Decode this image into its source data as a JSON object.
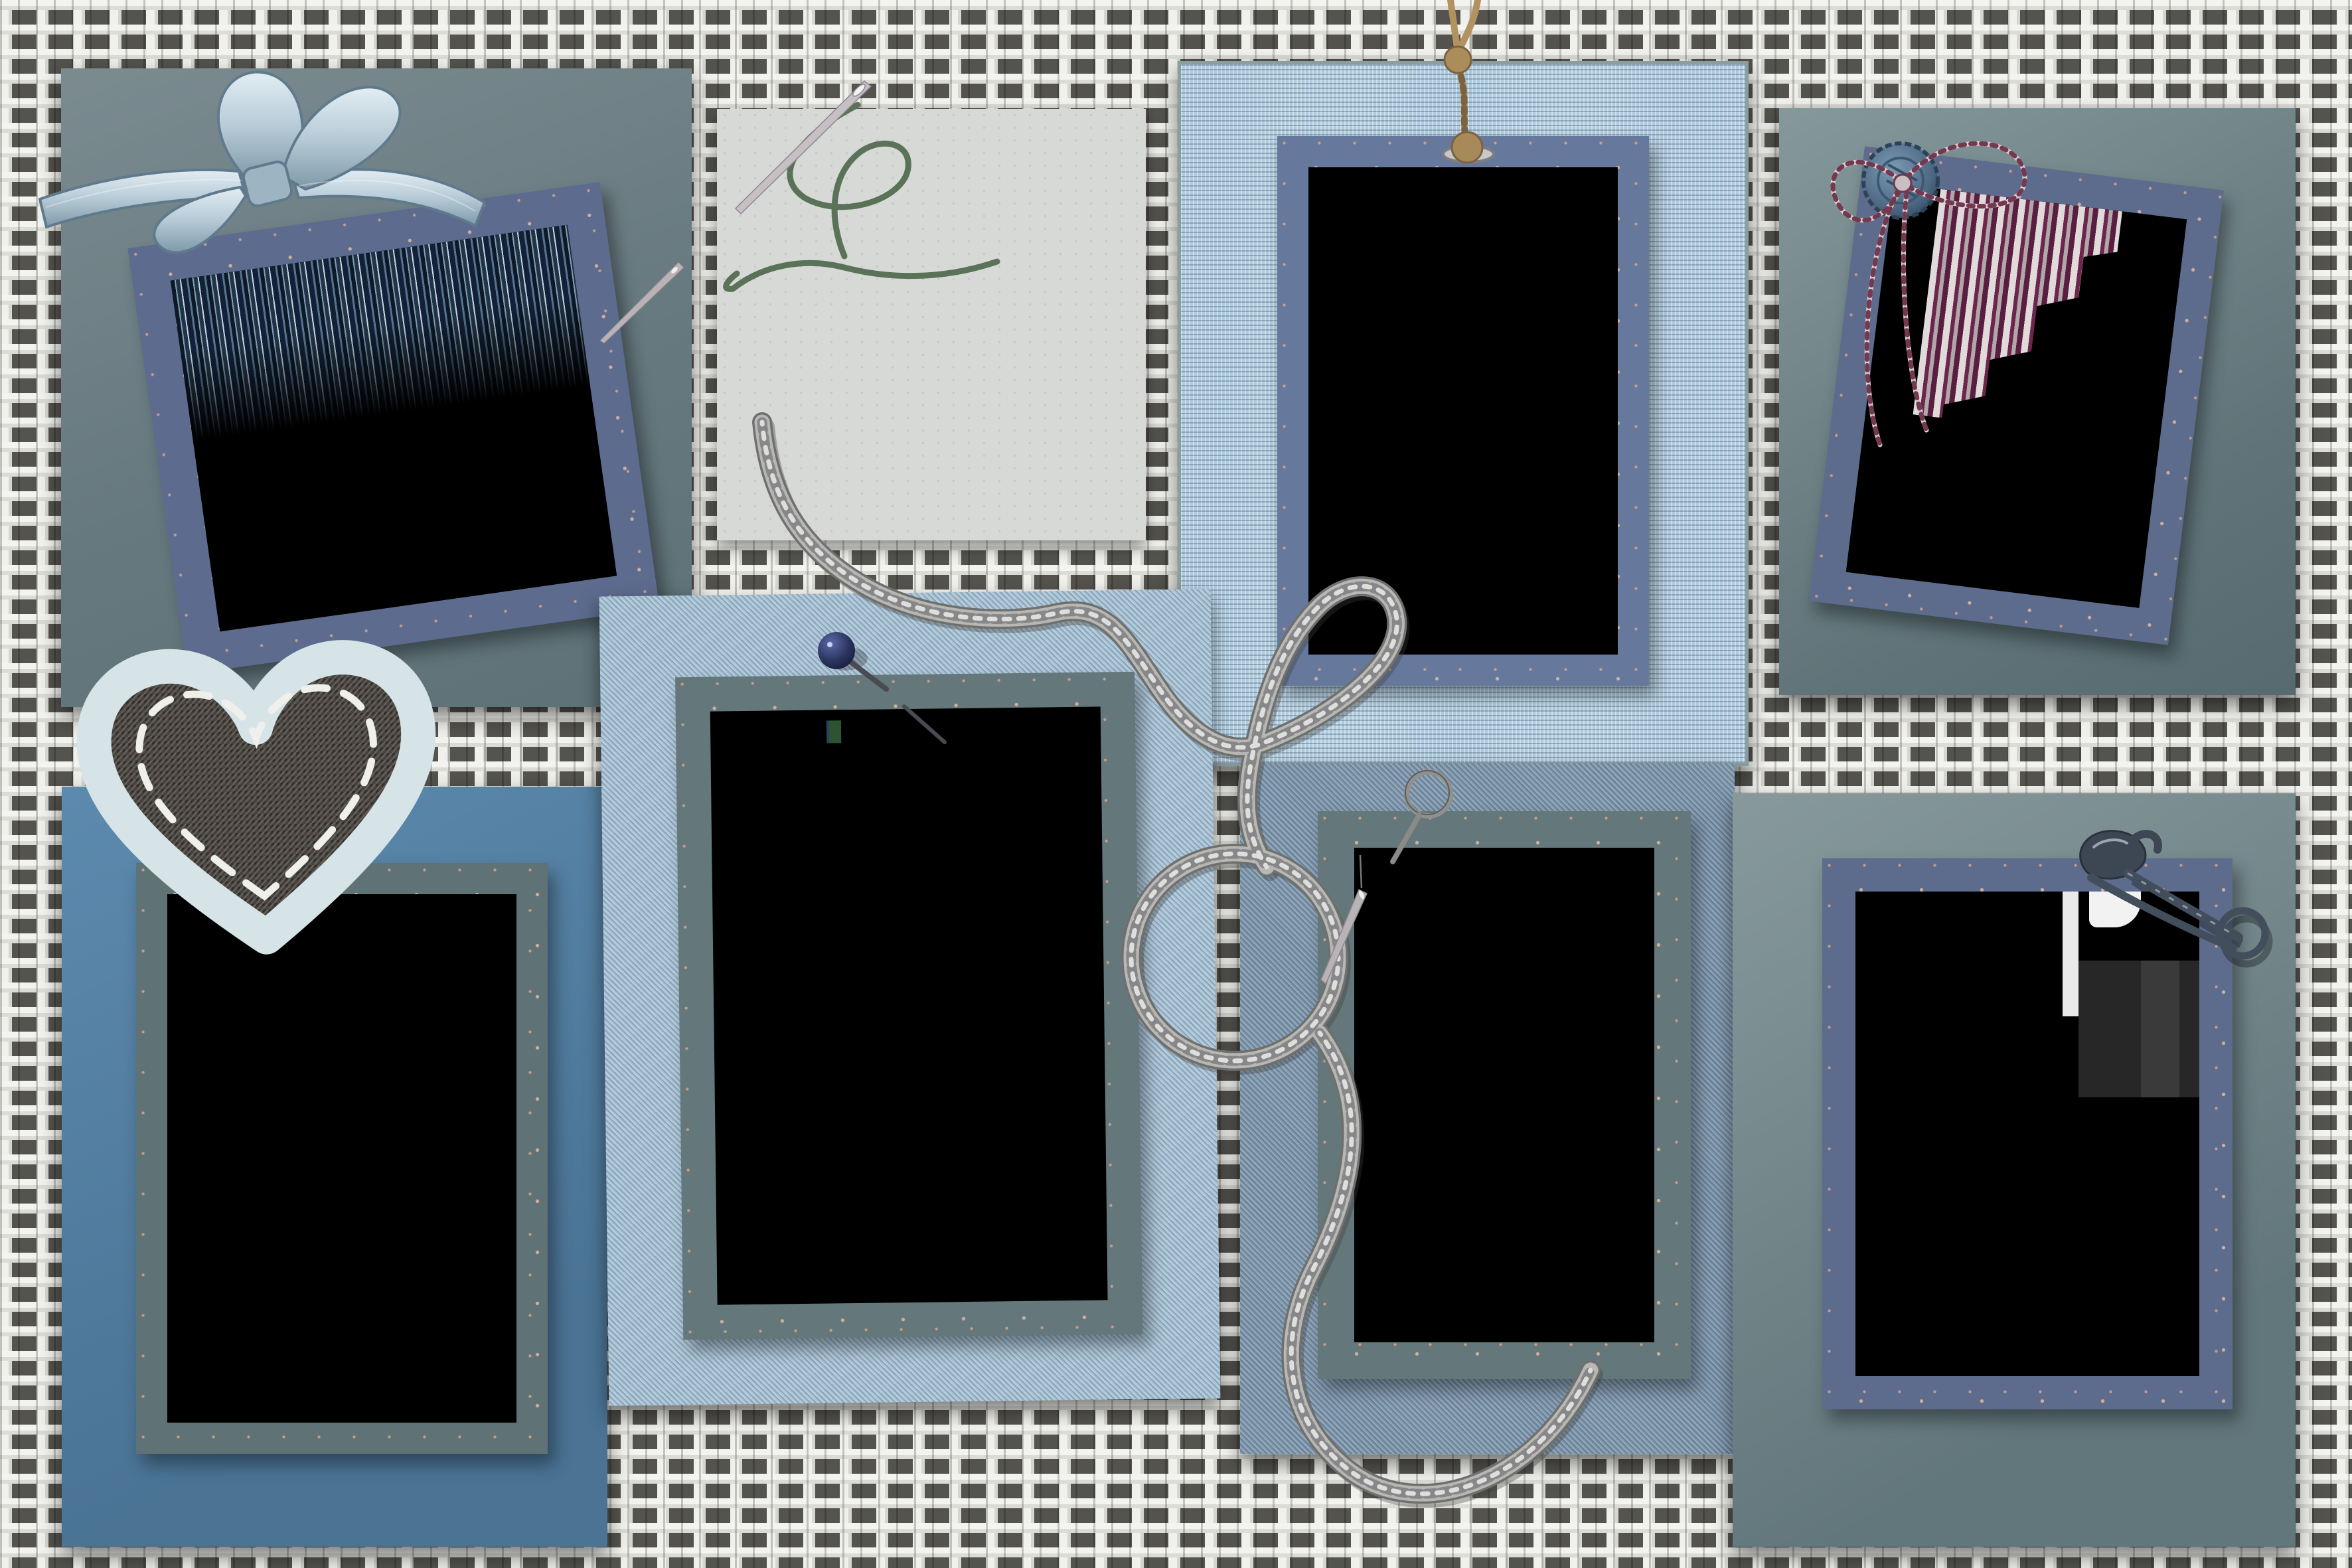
{
  "scene": {
    "label": "digital scrapbook photo-collage template on white burlap",
    "background": {
      "name": "burlap-weave-background",
      "label": "white burlap woven fabric",
      "thread_color": "#f2f2ef",
      "gap_color": "#4e4d4a"
    },
    "colors": {
      "slate_frame": "#5d6c8e",
      "sage_frame": "#64777b",
      "sage_mat": "#6e8288",
      "grey_mat": "#7b8e90",
      "light_blue_twill_mat": "#a9c3d6",
      "linen_mat": "#aecbdf",
      "steel_blue_mat": "#5585a9",
      "denim_mat": "#7e96ac",
      "paper": "#d7d9d7",
      "photo_placeholder": "#000000",
      "rope": "#b5b5b2",
      "twine": "#b2925f",
      "green_thread": "#5a7258",
      "ribbon": "#c3d4de",
      "heart_patch_edge": "#d6e4e8",
      "heart_patch_center": "#45413d",
      "speckle": "#eec0a4",
      "pin_head_navy": "#2c3560",
      "safety_pin_metal": "#434e5c"
    },
    "panels": [
      {
        "id": "p1",
        "label": "top-left sage mat with tilted slate photo frame and ribbon bow",
        "mat_color": "#6e8288",
        "frame_color": "#5d6c8e",
        "photo": "empty",
        "decorations": [
          "ribbon-bow",
          "sewing-needle"
        ]
      },
      {
        "id": "p2",
        "label": "grey paper square with threaded needle",
        "mat_color": "#d7d9d7",
        "frame_color": "none",
        "photo": "none",
        "decorations": [
          "sewing-needle",
          "green-thread"
        ]
      },
      {
        "id": "p3",
        "label": "light blue linen mat with slate frame hung on twine with grommet",
        "mat_color": "#aecbdf",
        "frame_color": "#66789b",
        "photo": "empty",
        "decorations": [
          "twine-hanger",
          "grommet"
        ]
      },
      {
        "id": "p4",
        "label": "top-right grey mat with tilted slate frame, denim button and twine bow",
        "mat_color": "#7b8e90",
        "frame_color": "#5d6c8c",
        "photo": "empty",
        "decorations": [
          "denim-button",
          "twine-bow"
        ]
      },
      {
        "id": "p5",
        "label": "center light blue twill mat with sage frame and straight pin",
        "mat_color": "#a9c3d6",
        "frame_color": "#64777b",
        "photo": "empty",
        "decorations": [
          "straight-pin"
        ]
      },
      {
        "id": "p6",
        "label": "bottom-left steel blue mat with sage frame and denim heart patch",
        "mat_color": "#5585a9",
        "frame_color": "#5f7275",
        "photo": "empty",
        "decorations": [
          "heart-patch"
        ]
      },
      {
        "id": "p7",
        "label": "bottom-center denim mat with sage frame, ring pin and needle",
        "mat_color": "#7e96ac",
        "frame_color": "#64777b",
        "photo": "empty",
        "decorations": [
          "ring-pin",
          "sewing-needle",
          "knit-rope"
        ]
      },
      {
        "id": "p8",
        "label": "bottom-right grey mat with slate frame and safety pin",
        "mat_color": "#7b8e90",
        "frame_color": "#5d6c8c",
        "photo": "empty",
        "decorations": [
          "safety-pin"
        ]
      }
    ],
    "decorations": [
      {
        "name": "ribbon-bow",
        "label": "woven light-blue ribbon bow",
        "color": "#c3d4de"
      },
      {
        "name": "knit-rope",
        "label": "grey knitted cord looping across center with two circles",
        "color": "#b5b5b2"
      },
      {
        "name": "heart-patch",
        "label": "stitched denim heart patch",
        "color": "#45413d"
      },
      {
        "name": "twine-hanger",
        "label": "knotted jute twine through grommet",
        "color": "#b2925f"
      },
      {
        "name": "denim-button",
        "label": "blue denim-look button with rope edge",
        "color": "#51677d"
      },
      {
        "name": "twine-bow",
        "label": "two-tone twisted twine bow with long tails",
        "color": "#d9ced1"
      },
      {
        "name": "green-thread",
        "label": "dark green embroidery thread",
        "color": "#5a7258"
      },
      {
        "name": "straight-pin",
        "label": "navy head straight pin",
        "color": "#2c3560"
      },
      {
        "name": "ring-pin",
        "label": "ring-head pin",
        "color": "#90908e"
      },
      {
        "name": "safety-pin",
        "label": "antique metal safety pin",
        "color": "#434e5c"
      },
      {
        "name": "sewing-needle",
        "label": "silver sewing needle",
        "color": "#b9b3b8"
      }
    ]
  }
}
